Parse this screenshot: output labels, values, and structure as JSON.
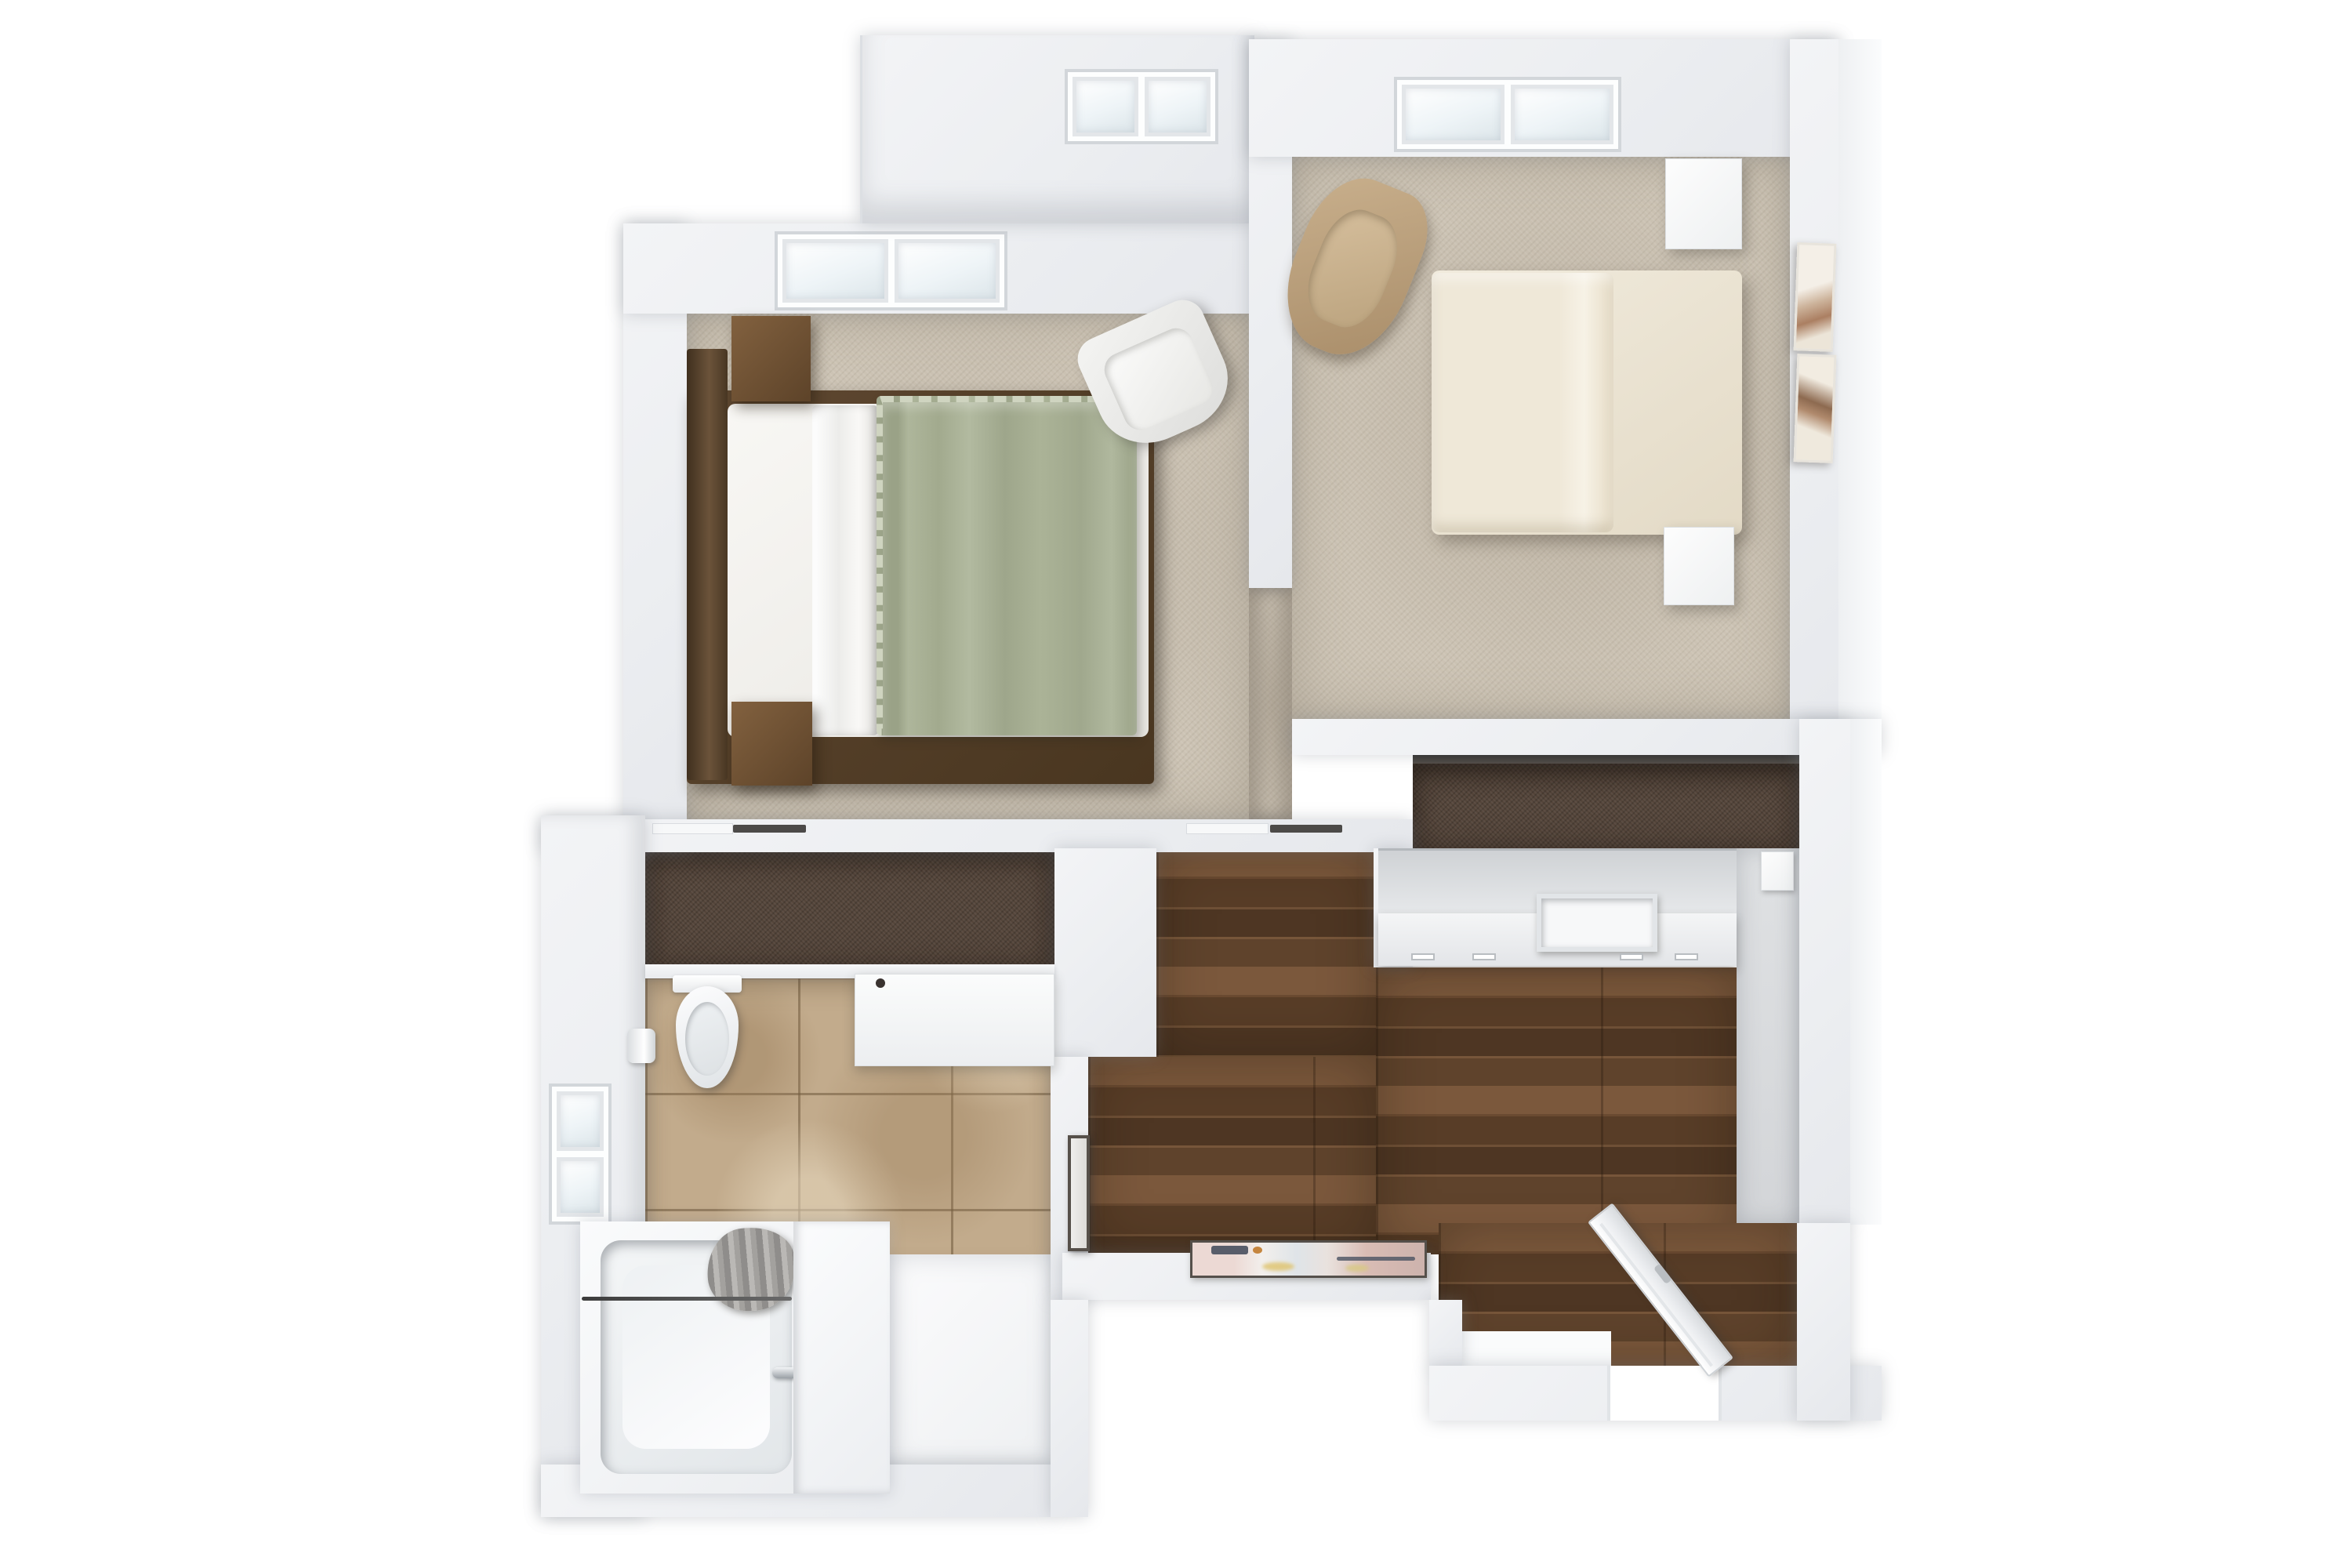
{
  "scene": {
    "title": "3D floor plan, top-down render of a two-bedroom suite",
    "view": "top-down 3D architectural rendering",
    "background": "#ffffff",
    "no_visible_text": true
  },
  "palette": {
    "wall": "#eff1f3",
    "wall_shadow": "#c9ccd0",
    "carpet_beige": "#ccc3b4",
    "carpet_closet_brown": "#54453a",
    "wood_floor": "#63462f",
    "tile_tan": "#c2ab8c",
    "floor_gray": "#d9dbdd",
    "fixture_white": "#f6f7f8",
    "blanket_sage_green": "#a9b295",
    "duvet_white": "#f7f6f3",
    "bed_cream": "#ece4d3",
    "headboard_dark_wood": "#5d4630",
    "headboard_tufted_brown": "#6e5945",
    "nightstand_wood": "#7b5c3c",
    "garment_dark": "#2a2c2e",
    "lamp_gold": "#cda65a",
    "lamp_glow": "#f8e9b4",
    "curtain_gray": "#a3a1a0",
    "chrome": "#c6ccd1",
    "artwork_pink": "#e3c6be",
    "artwork_navy": "#3e4657",
    "artwork_yellow": "#dfc36b"
  },
  "rooms": {
    "bedroom_1": {
      "position": "top-left",
      "floor": "beige carpet",
      "furniture": [
        "platform bed",
        "dark wood headboard",
        "white duvet",
        "sage green fringed throw blanket",
        "2 white pillows",
        "2 black-striped accent pillows",
        "2 wooden nightstands",
        "2 glowing ring lamps",
        "white accent armchair"
      ],
      "windows": [
        "double-pane skylight in north wall",
        "double-pane skylight in north bump-out"
      ]
    },
    "bedroom_2": {
      "position": "top-right",
      "floor": "beige carpet",
      "furniture": [
        "upholstered bed with cream duvet",
        "brown tufted headboard",
        "4 cream and white pillows",
        "2 white nightstands",
        "2 gold ring lamps",
        "tan woven accent chair",
        "leaning two-panel abstract artwork"
      ],
      "windows": [
        "double-pane skylight in north wall"
      ]
    },
    "closet_left": {
      "position": "middle-left walk-through",
      "floor": "dark brown carpet",
      "garments_on_rod": 18
    },
    "closet_right": {
      "position": "middle-right reach-in",
      "floor": "dark brown carpet",
      "garments_on_rod": 12,
      "furniture": [
        "long white dresser with one open drawer and drawer pulls"
      ]
    },
    "bathroom": {
      "position": "bottom-left",
      "floor": "tan stone tile",
      "fixtures": [
        "toilet",
        "toilet-paper holder",
        "white vanity counter with recessed sink and faucet handles",
        "bathtub with curtain rod",
        "bunched gray shower curtain",
        "chrome tub fixture",
        "white linen shelf unit",
        "window in west wall"
      ]
    },
    "hallway": {
      "position": "center-bottom",
      "floor": "walnut plank wood",
      "decor": [
        "framed pastel abstract artwork on south wall",
        "dark-framed mirror leaning on west wall"
      ]
    },
    "entry_vestibule": {
      "position": "bottom-right",
      "floor": "walnut plank wood",
      "features": [
        "door opening in south wall",
        "white door leaf swung open diagonally",
        "white threshold landing"
      ],
      "adjacent": "light gray dressing area strip"
    }
  },
  "closets": {
    "left": {
      "count": 18
    },
    "right": {
      "count": 12
    }
  }
}
